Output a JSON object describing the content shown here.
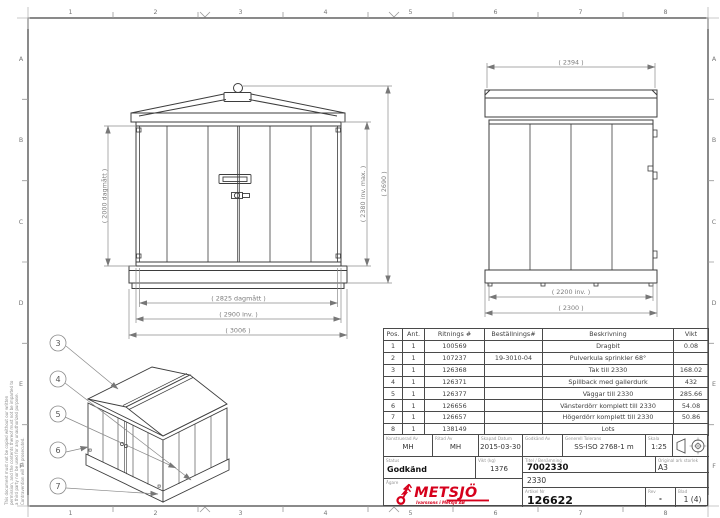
{
  "page": {
    "zone_cols": [
      "1",
      "2",
      "3",
      "4",
      "5",
      "6",
      "7",
      "8"
    ],
    "zone_rows": [
      "A",
      "B",
      "C",
      "D",
      "E",
      "F"
    ],
    "disclaimer": "This document must not be copied without our written permission, and the contents thereof must not be imparted to a third party nor be used for any unauthorized purpose. Contravention will be prosecuted."
  },
  "dims": {
    "front_door_height": "( 2000 dagmått )",
    "front_inner_height": "( 2380 inv. max. )",
    "front_total_height": "( 2690 )",
    "front_opening_width": "( 2825 dagmått )",
    "front_inner_width": "( 2900 inv. )",
    "front_total_width": "( 3006 )",
    "side_top_width": "( 2394 )",
    "side_inner_width": "( 2200 inv. )",
    "side_total_width": "( 2300 )"
  },
  "iso": {
    "balloons": [
      "3",
      "4",
      "5",
      "6",
      "7"
    ]
  },
  "parts_table": {
    "headers": {
      "pos": "Pos.",
      "ant": "Ant.",
      "ritnings": "Ritnings #",
      "bestallnings": "Beställnings#",
      "beskrivning": "Beskrivning",
      "vikt": "Vikt"
    },
    "rows": [
      {
        "pos": "1",
        "ant": "1",
        "ritnings": "100569",
        "bestallnings": "",
        "beskrivning": "Dragbit",
        "vikt": "0.08"
      },
      {
        "pos": "2",
        "ant": "1",
        "ritnings": "107237",
        "bestallnings": "19-3010-04",
        "beskrivning": "Pulverkula sprinkler 68°",
        "vikt": ""
      },
      {
        "pos": "3",
        "ant": "1",
        "ritnings": "126368",
        "bestallnings": "",
        "beskrivning": "Tak till 2330",
        "vikt": "168.02"
      },
      {
        "pos": "4",
        "ant": "1",
        "ritnings": "126371",
        "bestallnings": "",
        "beskrivning": "Spillback med gallerdurk",
        "vikt": "432"
      },
      {
        "pos": "5",
        "ant": "1",
        "ritnings": "126377",
        "bestallnings": "",
        "beskrivning": "Väggar till 2330",
        "vikt": "285.66"
      },
      {
        "pos": "6",
        "ant": "1",
        "ritnings": "126656",
        "bestallnings": "",
        "beskrivning": "Vänsterdörr komplett till 2330",
        "vikt": "54.08"
      },
      {
        "pos": "7",
        "ant": "1",
        "ritnings": "126657",
        "bestallnings": "",
        "beskrivning": "Högerdörr komplett till 2330",
        "vikt": "50.86"
      },
      {
        "pos": "8",
        "ant": "1",
        "ritnings": "138149",
        "bestallnings": "",
        "beskrivning": "Lots",
        "vikt": ""
      }
    ]
  },
  "title_block": {
    "konstruerad": {
      "label": "Konstruerad Av",
      "value": "MH"
    },
    "ritad": {
      "label": "Ritad Av",
      "value": "MH"
    },
    "skapad": {
      "label": "Skapad Datum",
      "value": "2015-03-30"
    },
    "godkand_av": {
      "label": "Godkänd Av",
      "value": ""
    },
    "tolerans": {
      "label": "Generell Tolerans",
      "value": "SS-ISO 2768-1 m"
    },
    "skala": {
      "label": "Skala",
      "value": "1:25"
    },
    "status": {
      "label": "Status",
      "value": "Godkänd"
    },
    "vikt": {
      "label": "Vikt (kg)",
      "value": "1376"
    },
    "titel": {
      "label": "Titel / Benämning",
      "value": "7002330",
      "value2": "2330"
    },
    "ark": {
      "label": "Original ark storlek",
      "value": "A3"
    },
    "agare": {
      "label": "Ägare"
    },
    "artikel": {
      "label": "Artikel Nr",
      "value": "126622"
    },
    "rev": {
      "label": "Rev",
      "value": "-"
    },
    "blad": {
      "label": "Blad",
      "value": "1 (4)"
    },
    "logo": {
      "name": "METSJÖ",
      "tagline": "Ivarssons i Metsjö AB",
      "color": "#d6001c"
    }
  }
}
